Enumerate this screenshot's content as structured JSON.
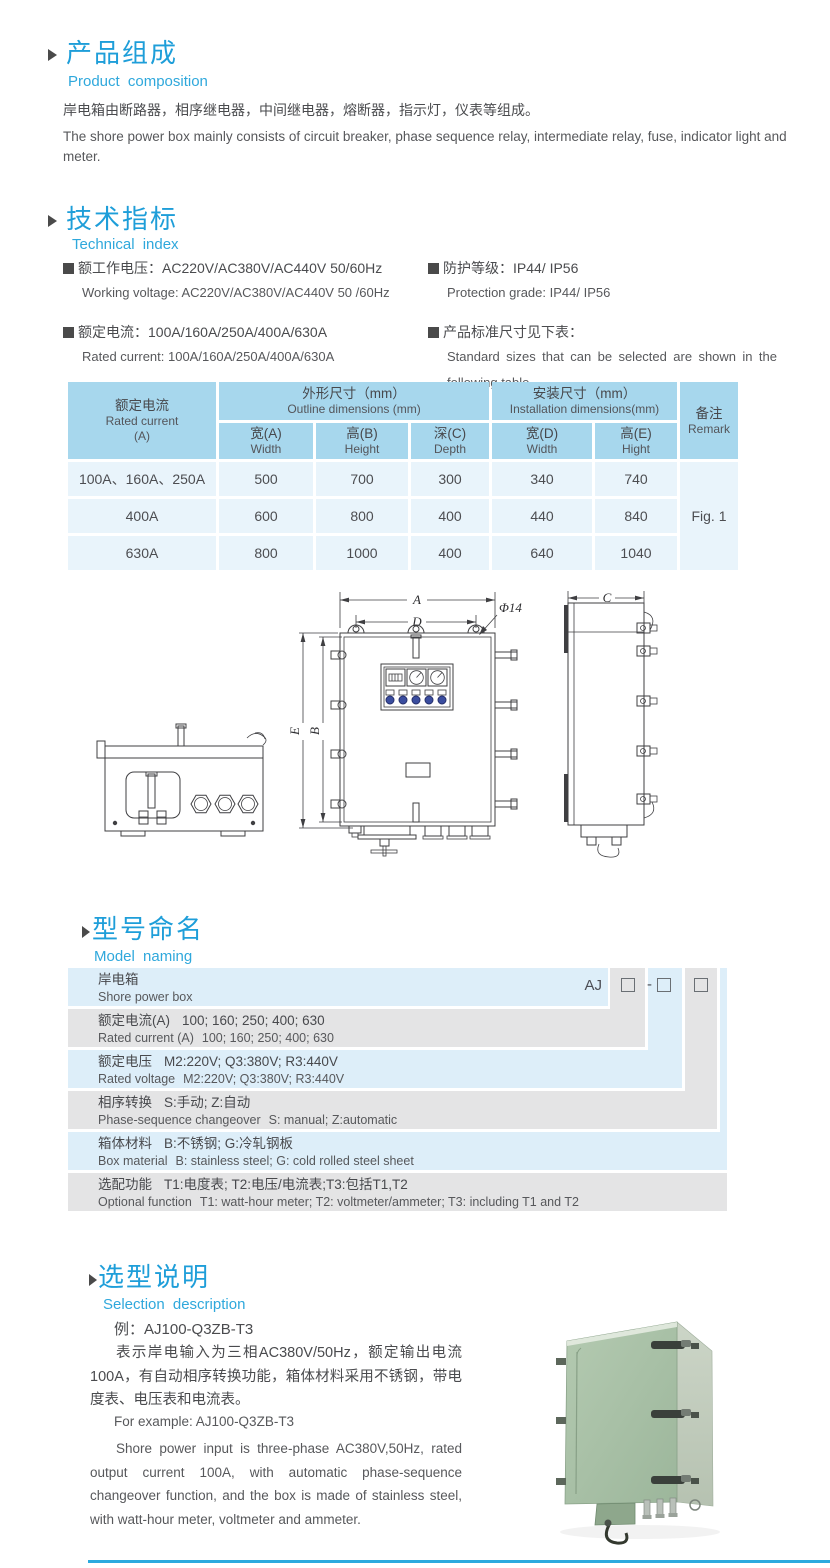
{
  "page": {
    "accent_blue": "#1e9ed9",
    "bottom_rule_color": "#2baade",
    "table_header_blue": "#a7d7ed",
    "table_row_blue": "#e9f4fb",
    "naming_blue": "#ddeef9",
    "naming_gray": "#e4e4e5"
  },
  "product_composition": {
    "title_zh": "产品组成",
    "title_en": "Product composition",
    "body_zh": "岸电箱由断路器，相序继电器，中间继电器，熔断器，指示灯，仪表等组成。",
    "body_en": "The shore power box mainly consists of circuit breaker, phase sequence relay, intermediate relay, fuse, indicator light and meter."
  },
  "technical_index": {
    "title_zh": "技术指标",
    "title_en": "Technical index",
    "specs": [
      {
        "zh": "额工作电压：AC220V/AC380V/AC440V  50/60Hz",
        "en": "Working voltage: AC220V/AC380V/AC440V 50 /60Hz"
      },
      {
        "zh": "额定电流：100A/160A/250A/400A/630A",
        "en": "Rated current: 100A/160A/250A/400A/630A"
      },
      {
        "zh": "防护等级：IP44/ IP56",
        "en": "Protection grade: IP44/ IP56"
      },
      {
        "zh": "产品标准尺寸见下表：",
        "en": "Standard sizes that can be selected are shown in the following table"
      }
    ]
  },
  "dimensions_table": {
    "header": {
      "rated_current_zh": "额定电流",
      "rated_current_en": "Rated current",
      "rated_current_unit": "(A)",
      "outline_zh": "外形尺寸（mm）",
      "outline_en": "Outline dimensions (mm)",
      "install_zh": "安装尺寸（mm）",
      "install_en": "Installation dimensions(mm)",
      "remark_zh": "备注",
      "remark_en": "Remark",
      "cols": [
        {
          "zh": "宽(A)",
          "en": "Width"
        },
        {
          "zh": "高(B)",
          "en": "Height"
        },
        {
          "zh": "深(C)",
          "en": "Depth"
        },
        {
          "zh": "宽(D)",
          "en": "Width"
        },
        {
          "zh": "高(E)",
          "en": "Hight"
        }
      ]
    },
    "rows": [
      {
        "current": "100A、160A、250A",
        "width_a": "500",
        "height_b": "700",
        "depth_c": "300",
        "width_d": "340",
        "height_e": "740"
      },
      {
        "current": "400A",
        "width_a": "600",
        "height_b": "800",
        "depth_c": "400",
        "width_d": "440",
        "height_e": "840"
      },
      {
        "current": "630A",
        "width_a": "800",
        "height_b": "1000",
        "depth_c": "400",
        "width_d": "640",
        "height_e": "1040"
      }
    ],
    "remark_value": "Fig. 1"
  },
  "figure": {
    "dim_a": "A",
    "dim_d": "D",
    "dim_dia": "Φ14",
    "dim_e": "E",
    "dim_b": "B",
    "dim_c": "C"
  },
  "model_naming": {
    "title_zh": "型号命名",
    "title_en": "Model naming",
    "code_prefix": "AJ",
    "code_dash": "-",
    "rows": [
      {
        "label_zh": "岸电箱",
        "label_en": "Shore power box"
      },
      {
        "label_zh": "额定电流(A)",
        "values_zh": "100; 160; 250; 400; 630",
        "label_en": "Rated current (A)",
        "values_en": "100; 160; 250; 400; 630"
      },
      {
        "label_zh": "额定电压",
        "values_zh": "M2:220V; Q3:380V; R3:440V",
        "label_en": "Rated voltage",
        "values_en": "M2:220V; Q3:380V; R3:440V"
      },
      {
        "label_zh": "相序转换",
        "values_zh": "S:手动; Z:自动",
        "label_en": "Phase-sequence changeover",
        "values_en": "S: manual; Z:automatic"
      },
      {
        "label_zh": "箱体材料",
        "values_zh": "B:不锈钢; G:冷轧钢板",
        "label_en": "Box material",
        "values_en": "B: stainless steel; G: cold rolled steel sheet"
      },
      {
        "label_zh": "选配功能",
        "values_zh": "T1:电度表; T2:电压/电流表;T3:包括T1,T2",
        "label_en": "Optional function",
        "values_en": "T1: watt-hour meter; T2: voltmeter/ammeter; T3: including T1 and T2"
      }
    ]
  },
  "selection": {
    "title_zh": "选型说明",
    "title_en": "Selection description",
    "example_zh": "例：AJ100-Q3ZB-T3",
    "body_zh": "表示岸电输入为三相AC380V/50Hz，额定输出电流100A，有自动相序转换功能，箱体材料采用不锈钢，带电度表、电压表和电流表。",
    "example_en": "For example: AJ100-Q3ZB-T3",
    "body_en": "Shore power input is three-phase AC380V,50Hz, rated output current 100A, with automatic phase-sequence changeover function, and the box is made of stainless steel, with watt-hour meter, voltmeter and ammeter."
  }
}
